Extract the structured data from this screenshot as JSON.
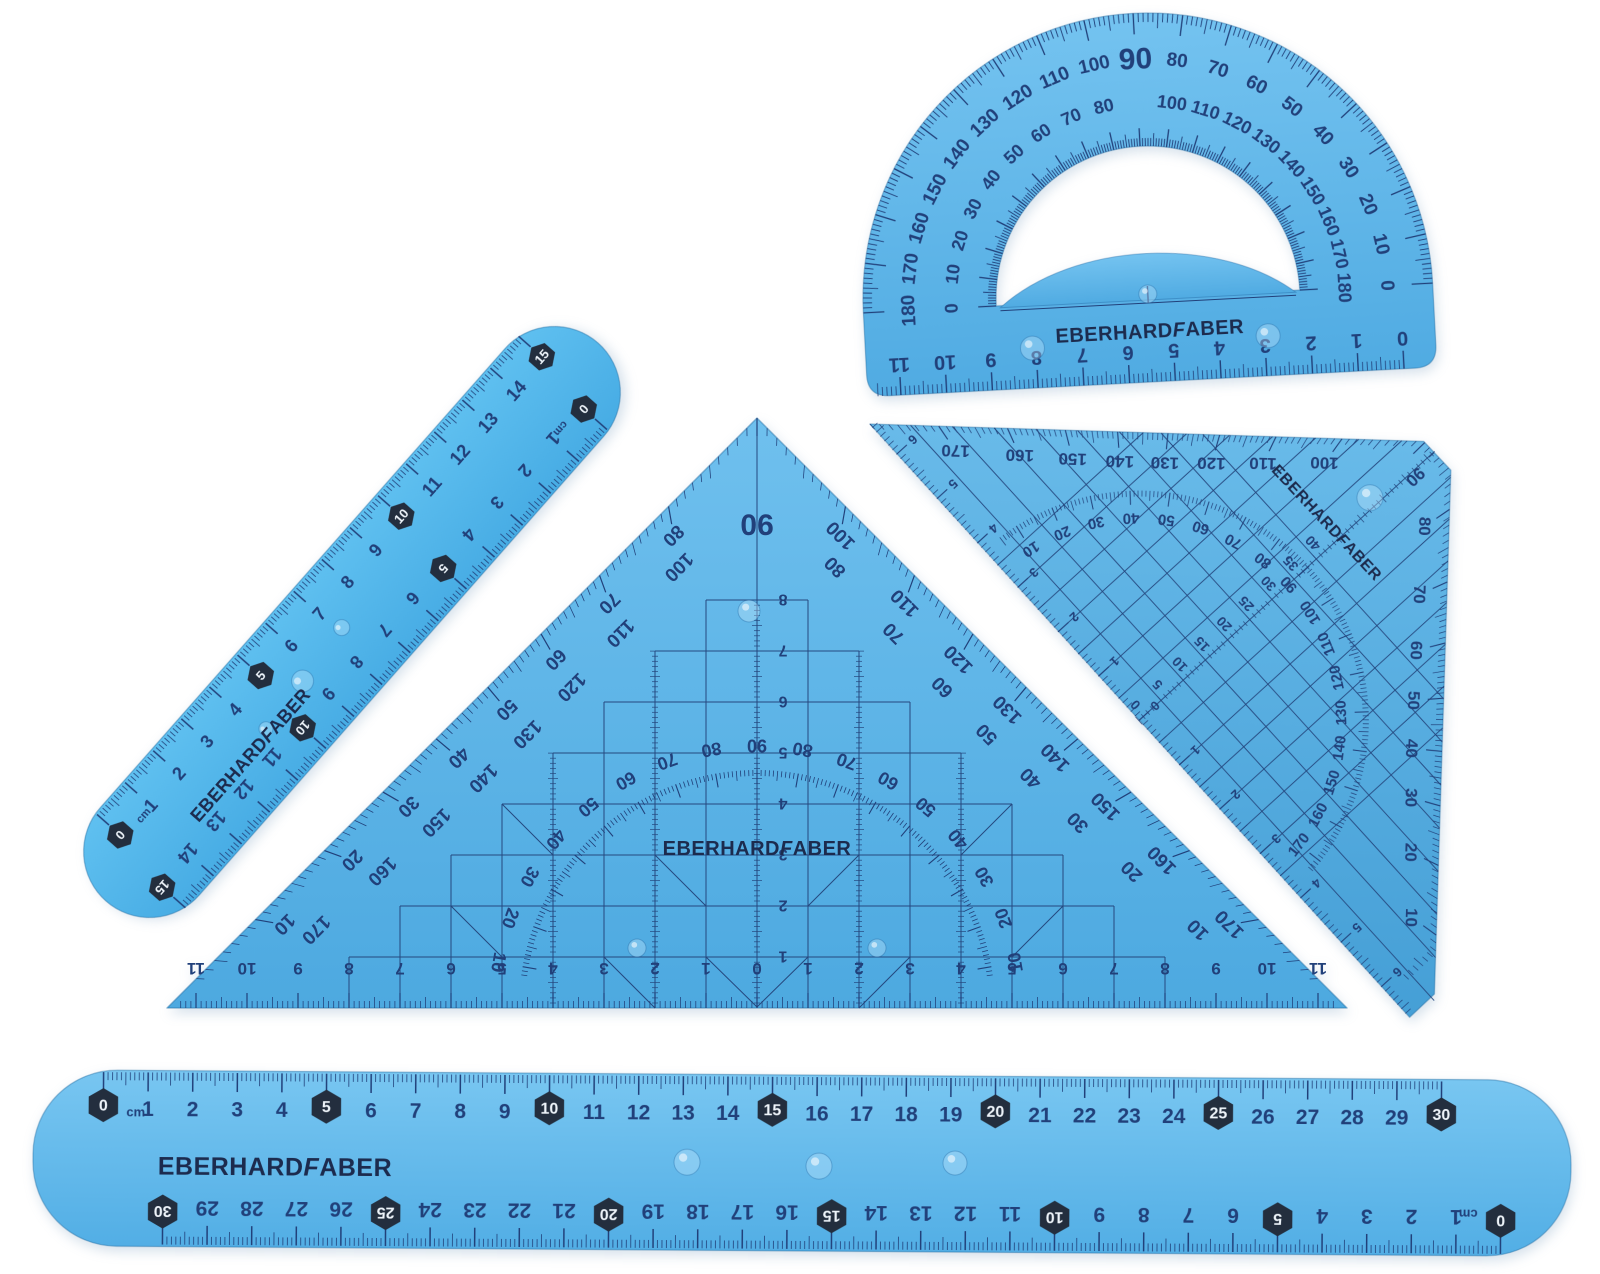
{
  "scene": {
    "background": "#ffffff",
    "description_brand": "EBERHARDFABER"
  },
  "colors": {
    "plastic": "#58b1e7",
    "plastic_light": "#7cc7f2",
    "plastic_deep": "#4aa5de",
    "ink": "#21407a",
    "brand_ink": "#1c2b4e",
    "badge_bg": "#232e3e",
    "badge_text": "#eef4fa",
    "background": "#ffffff"
  },
  "brand": {
    "part1": "EBERHARD",
    "part2": "F",
    "part3": "ABER"
  },
  "protractor": {
    "outer_deg": [
      "0",
      "10",
      "20",
      "30",
      "40",
      "50",
      "60",
      "70",
      "80",
      "90",
      "100",
      "110",
      "120",
      "130",
      "140",
      "150",
      "160",
      "170",
      "180"
    ],
    "inner_deg": [
      "180",
      "170",
      "160",
      "150",
      "140",
      "130",
      "120",
      "110",
      "100",
      "90",
      "80",
      "70",
      "60",
      "50",
      "40",
      "30",
      "20",
      "10",
      "0"
    ],
    "ruler_cm": [
      "0",
      "1",
      "2",
      "3",
      "4",
      "5",
      "6",
      "7",
      "8",
      "9",
      "10",
      "11"
    ]
  },
  "ruler15": {
    "unit": "cm",
    "numbers": [
      "0",
      "1",
      "2",
      "3",
      "4",
      "5",
      "6",
      "7",
      "8",
      "9",
      "10",
      "11",
      "12",
      "13",
      "14",
      "15"
    ],
    "badges": [
      0,
      5,
      10,
      15
    ]
  },
  "triangle_large": {
    "apex": "90",
    "arc": [
      "10",
      "20",
      "30",
      "40",
      "50",
      "60",
      "70",
      "80",
      "90",
      "80",
      "70",
      "60",
      "50",
      "40",
      "30",
      "20",
      "10"
    ],
    "left_pairs": [
      [
        "80",
        "100"
      ],
      [
        "70",
        "110"
      ],
      [
        "60",
        "120"
      ],
      [
        "50",
        "130"
      ],
      [
        "40",
        "140"
      ],
      [
        "30",
        "150"
      ],
      [
        "20",
        "160"
      ],
      [
        "10",
        "170"
      ]
    ],
    "right_pairs": [
      [
        "100",
        "80"
      ],
      [
        "110",
        "70"
      ],
      [
        "120",
        "60"
      ],
      [
        "130",
        "50"
      ],
      [
        "140",
        "40"
      ],
      [
        "150",
        "30"
      ],
      [
        "160",
        "20"
      ],
      [
        "170",
        "10"
      ]
    ],
    "center_cm": [
      "1",
      "2",
      "3",
      "4",
      "5",
      "6",
      "7",
      "8"
    ],
    "hyp": [
      "11",
      "10",
      "9",
      "8",
      "7",
      "6",
      "5",
      "4",
      "3",
      "2",
      "1",
      "0",
      "1",
      "2",
      "3",
      "4",
      "5",
      "6",
      "7",
      "8",
      "9",
      "10",
      "11"
    ]
  },
  "triangle_small": {
    "outer_top": [
      "100",
      "110",
      "120",
      "130",
      "140",
      "150",
      "160",
      "170"
    ],
    "corner": "90",
    "outer_right": [
      "10",
      "20",
      "30",
      "40",
      "50",
      "60",
      "70",
      "80"
    ],
    "inner_arc": [
      "10",
      "20",
      "30",
      "40",
      "50",
      "60",
      "70",
      "80",
      "90",
      "100",
      "110",
      "120",
      "130",
      "140",
      "150",
      "160",
      "170"
    ],
    "hyp_cm": [
      "6",
      "5",
      "4",
      "3",
      "2",
      "1",
      "0",
      "1",
      "2",
      "3",
      "4",
      "5",
      "6"
    ],
    "parallels": [
      "0",
      "5",
      "10",
      "15",
      "20",
      "25",
      "30",
      "35",
      "40"
    ]
  },
  "ruler30": {
    "unit": "cm",
    "numbers": [
      "0",
      "1",
      "2",
      "3",
      "4",
      "5",
      "6",
      "7",
      "8",
      "9",
      "10",
      "11",
      "12",
      "13",
      "14",
      "15",
      "16",
      "17",
      "18",
      "19",
      "20",
      "21",
      "22",
      "23",
      "24",
      "25",
      "26",
      "27",
      "28",
      "29",
      "30"
    ],
    "badges": [
      0,
      5,
      10,
      15,
      20,
      25,
      30
    ]
  }
}
